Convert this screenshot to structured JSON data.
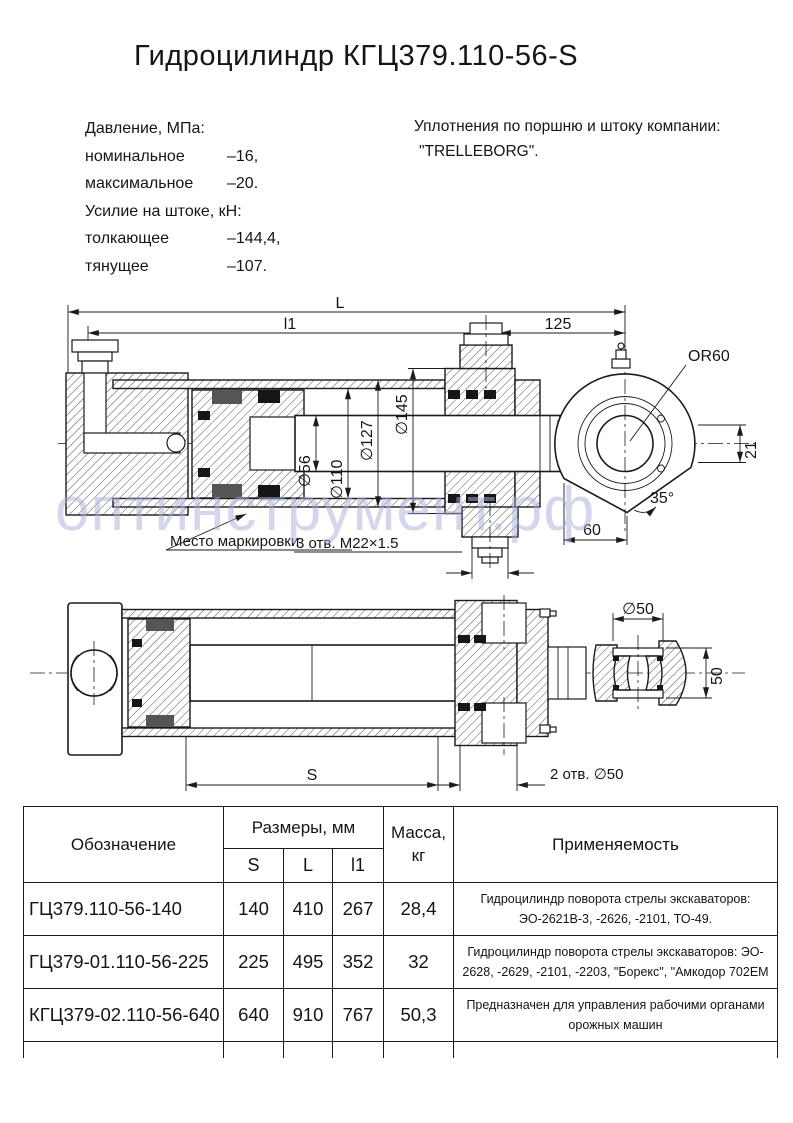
{
  "title": "Гидроцилиндр КГЦ379.110-56-S",
  "specs": {
    "rows": [
      {
        "label": "Давление, МПа:",
        "value": ""
      },
      {
        "label": "номинальное",
        "value": "–16,"
      },
      {
        "label": "максимальное",
        "value": "–20."
      },
      {
        "label": "Усилие на штоке, кН:",
        "value": ""
      },
      {
        "label": "толкающее",
        "value": "–144,4,"
      },
      {
        "label": "тянущее",
        "value": "–107."
      }
    ]
  },
  "seals_note": {
    "line1": "Уплотнения по поршню и штоку компании:",
    "line2": "\"TRELLEBORG\"."
  },
  "watermark": "оптинструмент.рф",
  "drawing1": {
    "L": "L",
    "l1": "l1",
    "len125": "125",
    "or60": "OR60",
    "d56": "∅56",
    "d110": "∅110",
    "d127": "∅127",
    "d145": "∅145",
    "off21": "21",
    "ang35": "35°",
    "w60": "60",
    "marking": "Место маркировки",
    "ports": "3 отв. М22×1.5"
  },
  "drawing2": {
    "d50": "∅50",
    "w50": "50",
    "S": "S",
    "holes": "2 отв. ∅50"
  },
  "table": {
    "headers": {
      "designation": "Обозначение",
      "sizes": "Размеры, мм",
      "s": "S",
      "l": "L",
      "l1": "l1",
      "mass": "Масса,\nкг",
      "application": "Применяемость"
    },
    "rows": [
      {
        "designation": "ГЦ379.110-56-140",
        "s": "140",
        "l": "410",
        "l1": "267",
        "mass": "28,4",
        "application": "Гидроцилиндр поворота стрелы экскаваторов:\nЭО-2621В-3, -2626, -2101, ТО-49."
      },
      {
        "designation": "ГЦ379-01.110-56-225",
        "s": "225",
        "l": "495",
        "l1": "352",
        "mass": "32",
        "application": "Гидроцилиндр поворота стрелы экскаваторов: ЭО-\n2628, -2629, -2101, -2203, \"Борекс\", \"Амкодор 702ЕМ"
      },
      {
        "designation": "КГЦ379-02.110-56-640",
        "s": "640",
        "l": "910",
        "l1": "767",
        "mass": "50,3",
        "application": "Предназначен для управления рабочими органами\nорожных машин"
      }
    ]
  }
}
